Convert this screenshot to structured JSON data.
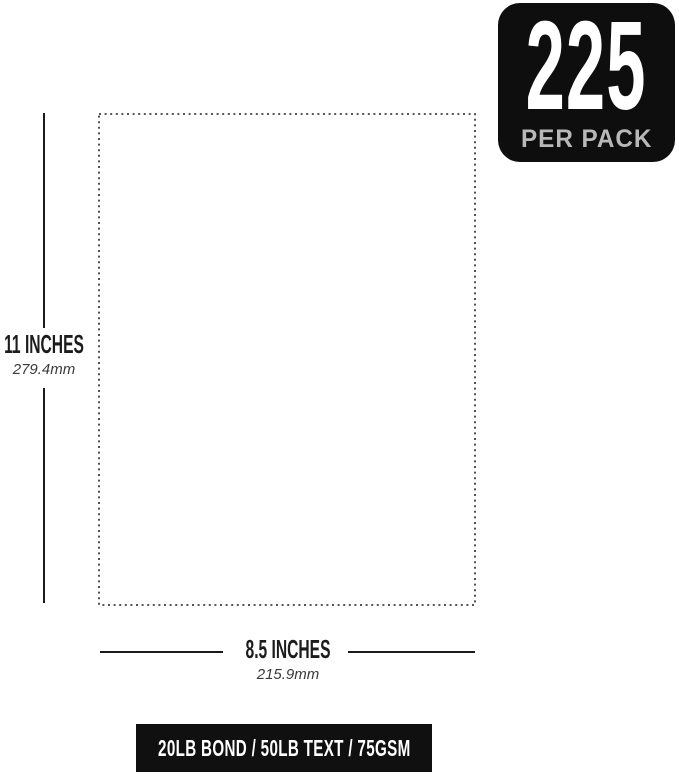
{
  "badge": {
    "count": "225",
    "label": "PER PACK",
    "background_color": "#0e0e0e",
    "count_color": "#ffffff",
    "label_color": "#b8b8b8"
  },
  "paper": {
    "height_label": "11 INCHES",
    "height_metric": "279.4mm",
    "width_label": "8.5 INCHES",
    "width_metric": "215.9mm",
    "outline_style": "dotted",
    "outline_color": "#3f3f3f",
    "fill_color": "#ffffff"
  },
  "measurement_lines": {
    "color": "#1b1b1b"
  },
  "spec_bar": {
    "text": "20LB BOND / 50LB TEXT / 75GSM",
    "background_color": "#101010",
    "text_color": "#ffffff"
  }
}
